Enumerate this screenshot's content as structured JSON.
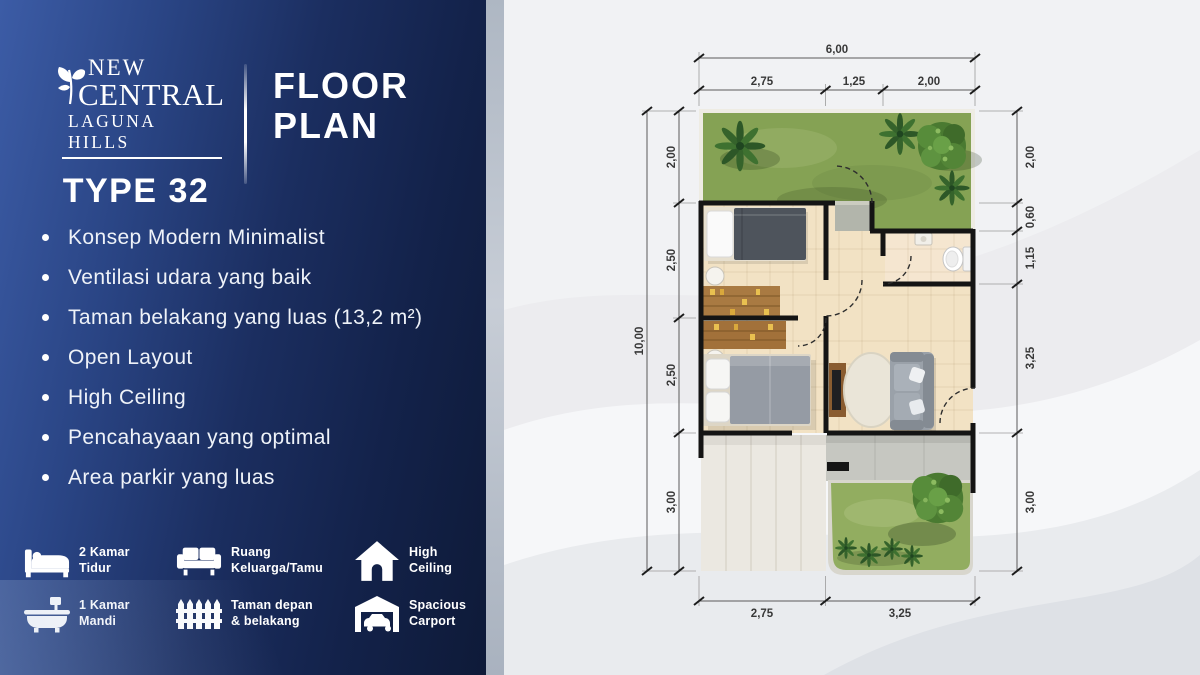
{
  "brand": {
    "name_line1": "NEW",
    "name_line2": "CENTRAL",
    "name_line3": "LAGUNA HILLS",
    "type_label": "TYPE 32"
  },
  "heading": {
    "line1": "FLOOR",
    "line2": "PLAN"
  },
  "features": [
    "Konsep Modern Minimalist",
    "Ventilasi udara yang baik",
    "Taman belakang yang luas (13,2 m²)",
    "Open Layout",
    "High Ceiling",
    "Pencahayaan yang optimal",
    "Area parkir yang luas"
  ],
  "amenities": [
    {
      "icon": "bed-icon",
      "line1": "2 Kamar",
      "line2": "Tidur"
    },
    {
      "icon": "sofa-icon",
      "line1": "Ruang",
      "line2": "Keluarga/Tamu"
    },
    {
      "icon": "house-icon",
      "line1": "High",
      "line2": "Ceiling"
    },
    {
      "icon": "bathtub-icon",
      "line1": "1 Kamar",
      "line2": "Mandi"
    },
    {
      "icon": "fence-icon",
      "line1": "Taman depan",
      "line2": "& belakang"
    },
    {
      "icon": "carport-icon",
      "line1": "Spacious",
      "line2": "Carport"
    }
  ],
  "floorplan": {
    "dims": {
      "top_overall": "6,00",
      "top": [
        "2,75",
        "1,25",
        "2,00"
      ],
      "left_overall": "10,00",
      "left": [
        "2,00",
        "2,50",
        "2,50",
        "3,00"
      ],
      "right": [
        "2,00",
        "0,60",
        "1,15",
        "3,25",
        "3,00"
      ],
      "bottom": [
        "2,75",
        "3,25"
      ]
    }
  },
  "colors": {
    "panel_blue_light": "#3c5ca6",
    "panel_blue_dark": "#0e1a38",
    "band_gray": "#b7c0cb",
    "grass_green": "#85a254",
    "floor_beige": "#f2e2c4",
    "wall_black": "#141414",
    "dim_text": "#383838"
  }
}
